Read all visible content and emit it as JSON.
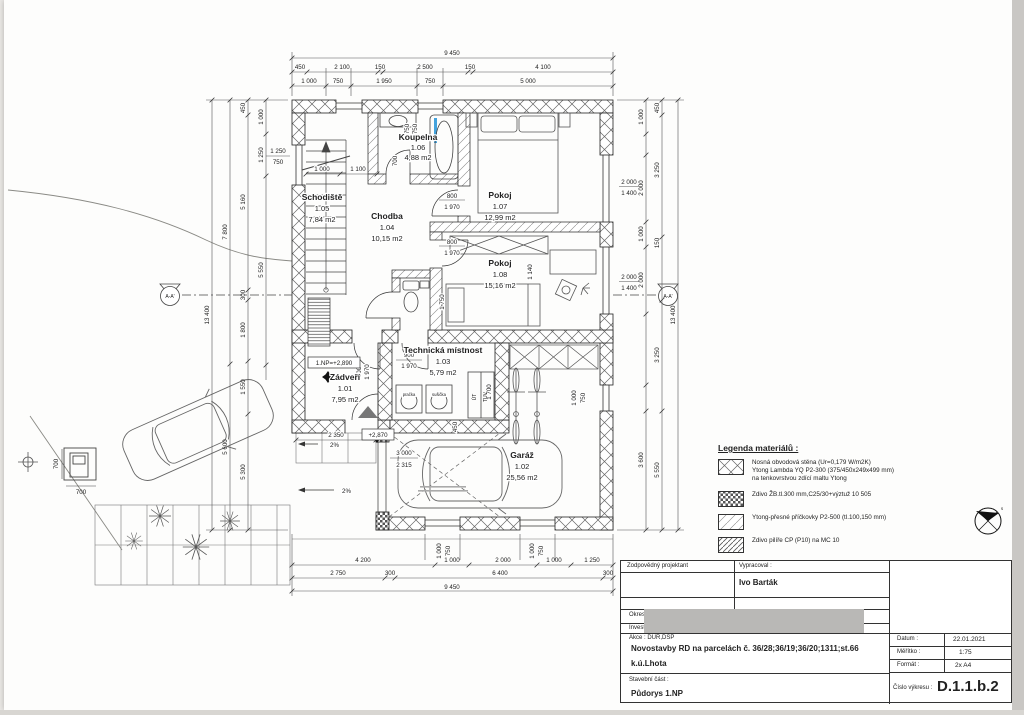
{
  "plan": {
    "rooms": [
      {
        "name": "Zádveří",
        "num": "1.01",
        "area": "7,95 m2"
      },
      {
        "name": "Garáž",
        "num": "1.02",
        "area": "25,56 m2"
      },
      {
        "name": "Technická místnost",
        "num": "1.03",
        "area": "5,79 m2"
      },
      {
        "name": "Chodba",
        "num": "1.04",
        "area": "10,15 m2"
      },
      {
        "name": "Schodiště",
        "num": "1.05",
        "area": "7,84 m2"
      },
      {
        "name": "Koupelna",
        "num": "1.06",
        "area": "4,88 m2"
      },
      {
        "name": "Pokoj",
        "num": "1.07",
        "area": "12,99 m2"
      },
      {
        "name": "Pokoj",
        "num": "1.08",
        "area": "15,16 m2"
      }
    ],
    "levels": {
      "floor": "1.NP=+2,890",
      "porch": "+2,870",
      "slope": "2%"
    },
    "fixtures": {
      "washer": "pračka",
      "dryer": "sušička",
      "ut": "ÚT",
      "tuv": "TUV"
    },
    "section": "A-A'",
    "compass_letter": "s"
  },
  "dims": {
    "t_total": "9 450",
    "t2": [
      "450",
      "2 100",
      "150",
      "2 500",
      "150",
      "4 100"
    ],
    "t3": [
      "1 000",
      "750",
      "1 950",
      "750",
      "5 000"
    ],
    "l_total": "13 400",
    "la": [
      "7 800",
      "5 600"
    ],
    "lb": [
      "450",
      "5 160",
      "300",
      "1 800",
      "1 550",
      "5 300"
    ],
    "lc": [
      "1 000",
      "1 250",
      "5 550"
    ],
    "lwin": [
      "1 250",
      "750"
    ],
    "r_total": "13 400",
    "ra": [
      "1 000",
      "2 000",
      "1 000",
      "2 000",
      "3 600"
    ],
    "rb": [
      "450",
      "3 250",
      "150",
      "3 250",
      "5 550"
    ],
    "rw": [
      "2 000",
      "1 400"
    ],
    "wsm": [
      "1 000",
      "750"
    ],
    "b_r1": [
      "4 200",
      "1 000",
      "2 000",
      "1 000",
      "1 250"
    ],
    "b_r2": [
      "2 750",
      "300",
      "6 400",
      "300"
    ],
    "b_total": "9 450",
    "d800": "800",
    "d900": "900",
    "d1970": "1 970",
    "d700": "700",
    "d750": "750",
    "i1000": "1 000",
    "i1100": "1 100",
    "i1750": "1 750",
    "i1140": "1 140",
    "i1700": "1 700",
    "i2350": "2 350",
    "i450": "450",
    "g_w": "3 000",
    "g_h": "2 315",
    "m700": "700"
  },
  "legend": {
    "title": "Legenda materiálů :",
    "items": [
      {
        "lines": [
          "Nosná obvodová stěna (Ur=0,179 W/m2K)",
          "Ytong Lambda YQ P2-300 (375/450x249x499 mm)",
          "na tenkovrstvou zdící maltu Ytong"
        ]
      },
      {
        "lines": [
          "Zdivo ŽB.tl.300 mm,C25/30+výztuž 10 505"
        ]
      },
      {
        "lines": [
          "Ytong-přesné příčkovky P2-500 (tl.100,150 mm)"
        ]
      },
      {
        "lines": [
          "Zdivo pilíře CP (P10) na MC 10"
        ]
      }
    ]
  },
  "titleblock": {
    "responsible_label": "Zodpovědný projektant",
    "prepared_label": "Vypracoval :",
    "prepared_name": "Ivo Barták",
    "okres_label": "Okres :",
    "investor_label": "Investor",
    "akce_label": "Akce : DUR,DSP",
    "akce_line1": "Novostavby RD na parcelách č. 36/28;36/19;36/20;1311;st.66",
    "akce_line2": "k.ú.Lhota",
    "datum_label": "Datum :",
    "datum": "22.01.2021",
    "meritko_label": "Měřítko :",
    "meritko": "1:75",
    "format_label": "Formát :",
    "format": "2x A4",
    "part_label": "Stavební část :",
    "part_name": "Půdorys 1.NP",
    "no_label": "Číslo výkresu :",
    "no": "D.1.1.b.2"
  }
}
